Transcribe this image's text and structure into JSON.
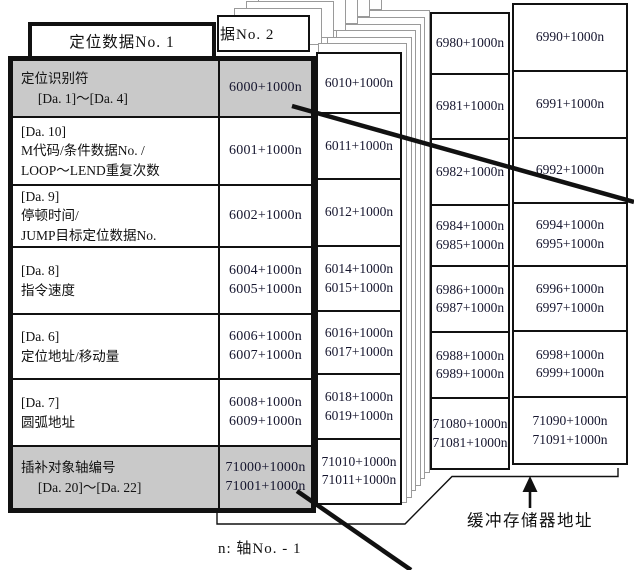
{
  "card1": {
    "title": "定位数据No. 1",
    "rows": [
      {
        "line1": "定位识别符",
        "line2": "　 [Da. 1]～[Da. 4]",
        "line3": "",
        "addr1": "6000+1000n",
        "addr2": "",
        "shaded": true
      },
      {
        "line1": "[Da. 10]",
        "line2": "M代码/条件数据No. /",
        "line3": "LOOP～LEND重复次数",
        "addr1": "6001+1000n",
        "addr2": "",
        "shaded": false
      },
      {
        "line1": "[Da. 9]",
        "line2": "停顿时间/",
        "line3": "JUMP目标定位数据No.",
        "addr1": "6002+1000n",
        "addr2": "",
        "shaded": false
      },
      {
        "line1": "[Da. 8]",
        "line2": "指令速度",
        "line3": "",
        "addr1": "6004+1000n",
        "addr2": "6005+1000n",
        "shaded": false
      },
      {
        "line1": "[Da. 6]",
        "line2": "定位地址/移动量",
        "line3": "",
        "addr1": "6006+1000n",
        "addr2": "6007+1000n",
        "shaded": false
      },
      {
        "line1": "[Da. 7]",
        "line2": "圆弧地址",
        "line3": "",
        "addr1": "6008+1000n",
        "addr2": "6009+1000n",
        "shaded": false
      },
      {
        "line1": "插补对象轴编号",
        "line2": "　 [Da. 20]～[Da. 22]",
        "line3": "",
        "addr1": "71000+1000n",
        "addr2": "71001+1000n",
        "shaded": true
      }
    ]
  },
  "card2": {
    "title": "据No. 2",
    "rows": [
      {
        "addr1": "6010+1000n",
        "addr2": ""
      },
      {
        "addr1": "6011+1000n",
        "addr2": ""
      },
      {
        "addr1": "6012+1000n",
        "addr2": ""
      },
      {
        "addr1": "6014+1000n",
        "addr2": "6015+1000n"
      },
      {
        "addr1": "6016+1000n",
        "addr2": "6017+1000n"
      },
      {
        "addr1": "6018+1000n",
        "addr2": "6019+1000n"
      },
      {
        "addr1": "71010+1000n",
        "addr2": "71011+1000n"
      }
    ]
  },
  "card99": {
    "rows": [
      {
        "addr1": "6980+1000n",
        "addr2": ""
      },
      {
        "addr1": "6981+1000n",
        "addr2": ""
      },
      {
        "addr1": "6982+1000n",
        "addr2": ""
      },
      {
        "addr1": "6984+1000n",
        "addr2": "6985+1000n"
      },
      {
        "addr1": "6986+1000n",
        "addr2": "6987+1000n"
      },
      {
        "addr1": "6988+1000n",
        "addr2": "6989+1000n"
      },
      {
        "addr1": "71080+1000n",
        "addr2": "71081+1000n"
      }
    ]
  },
  "card100": {
    "rows": [
      {
        "addr1": "6990+1000n",
        "addr2": ""
      },
      {
        "addr1": "6991+1000n",
        "addr2": ""
      },
      {
        "addr1": "6992+1000n",
        "addr2": ""
      },
      {
        "addr1": "6994+1000n",
        "addr2": "6995+1000n"
      },
      {
        "addr1": "6996+1000n",
        "addr2": "6997+1000n"
      },
      {
        "addr1": "6998+1000n",
        "addr2": "6999+1000n"
      },
      {
        "addr1": "71090+1000n",
        "addr2": "71091+1000n"
      }
    ]
  },
  "annotations": {
    "buffer_label": "缓冲存储器地址",
    "footnote": "n: 轴No. - 1"
  },
  "colors": {
    "border": "#111111",
    "shaded_cell": "#c9c9c9",
    "outline_gray": "#9a9a9a",
    "address_text": "#15152e"
  }
}
